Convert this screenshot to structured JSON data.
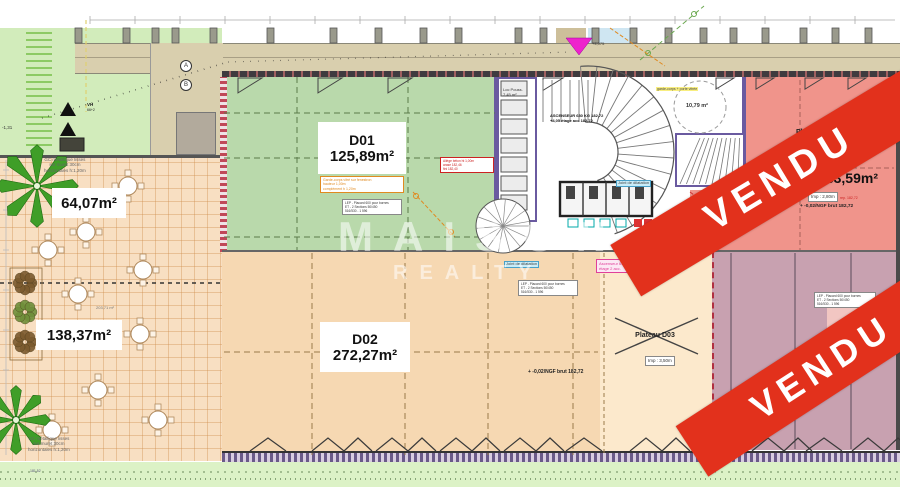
{
  "watermark": {
    "line1": "MAISON",
    "line2": "REALTY"
  },
  "banners": {
    "top": "VENDU",
    "bottom": "VENDU"
  },
  "colors": {
    "vendu_red": "#e2311c",
    "d01_green": "#b9d9ab",
    "terrace_orange": "#f8dfc2",
    "d02_orange": "#f6d8b2",
    "d05_pink": "#f0948b",
    "d04_mauve": "#c8a1b0",
    "d03_cream": "#fce9cc",
    "landscape_green": "#d2ecbb",
    "walkway_beige": "#d9cfae",
    "wall_purple": "#6a5aa0"
  },
  "units": {
    "d01": {
      "name": "D01",
      "area": "125,89m²"
    },
    "d02": {
      "name": "D02",
      "area": "272,27m²"
    },
    "terrace_upper_area": "64,07m²",
    "terrace_lower_area": "138,37m²",
    "d05": {
      "plateau": "Plateau D05",
      "area_small": "133,70",
      "area_big": "133,59m²",
      "imp": "Imp : 2,80m",
      "ngf": "+ -0,02/NGF brut 182,72"
    },
    "d03": {
      "plateau": "Plateau D03",
      "imp": "Imp : 3,50m"
    },
    "d04": {
      "name": "D04"
    },
    "d02_ngf": "+ -0,02/NGF brut 182,72",
    "stair_room_area": "10,79 m²",
    "terrace_mid_area": "203,71 m²",
    "green_dim": "181,52"
  },
  "annotations": {
    "gc": [
      "GC métallique lisses",
      "sur muret 30cm",
      "horizontales h:1,20m"
    ],
    "cabinet_box": [
      "LEP - Placard 600 pour bornes",
      "ET - 2 Sections 50/450",
      "516/530 - 1 596"
    ],
    "red_box": [
      "Allège béton ht 1,00m",
      "arase 182,46",
      "fini 182,40"
    ],
    "orange_box": [
      "Garde-corps vitré sur fenestron",
      "hauteur 1,00m",
      "complément h 1,20m"
    ],
    "elevator_black": [
      "ASCENSEUR 630 KG 182,72",
      "+4,05 étage acc 182,72"
    ],
    "elevator_pink": [
      "Ascenseur 630K 655",
      "étage 2 acc."
    ],
    "cyan_label": "Joint de dilatation",
    "yellow_label": "garde-corps + porte vitrée",
    "loc_pouss": [
      "Loc Pouss.",
      "7,45 m²"
    ],
    "vh": "VH",
    "vh_sub": "66+2",
    "level_top": "+4,075",
    "neg_level": "-1,31",
    "red_note": "rep. 182,72",
    "marks": [
      "A",
      "B"
    ]
  },
  "icons": {
    "palm_icon": "star-shaped palm plant",
    "shrub_icon": "round shrub",
    "table_icon": "round table with chairs",
    "marker_triangle_icon": "magenta survey triangle",
    "vent_triangle_icon": "black VH triangle",
    "stair_icon": "staircase fan"
  }
}
